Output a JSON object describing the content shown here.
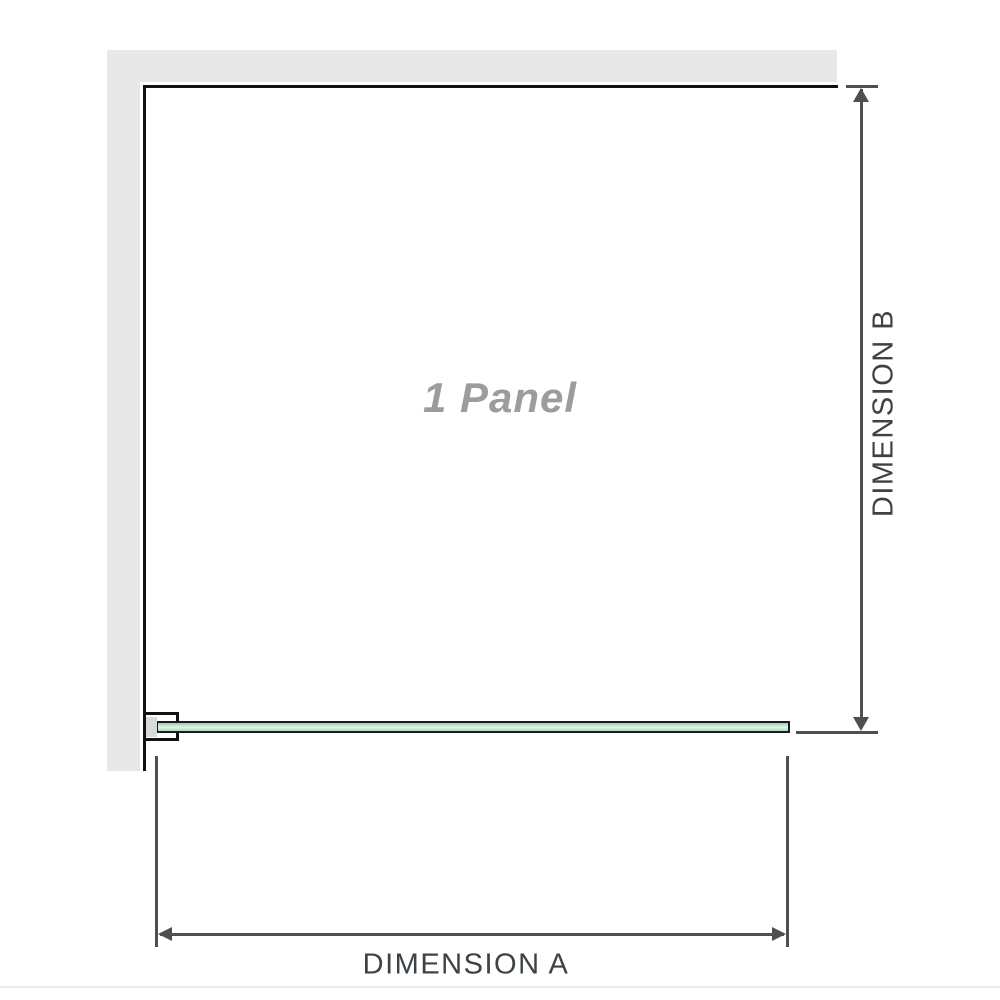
{
  "diagram": {
    "panel_label": "1 Panel",
    "dimension_a_label": "DIMENSION A",
    "dimension_b_label": "DIMENSION B"
  },
  "colors": {
    "wall_fill": "#e8e8e8",
    "outline": "#111111",
    "dimension_line": "#4f4f4f",
    "label_text": "#3d4246",
    "panel_label_text": "#9c9c9c",
    "glass_green_dark": "#96cfae",
    "glass_green_light": "#e2f4e8",
    "glass_green_mid": "#a9dcc0",
    "bracket_fill": "#ffffff",
    "bracket_inner_gray": "#d9d9d9",
    "baseline_rule": "#f0ebe5"
  }
}
